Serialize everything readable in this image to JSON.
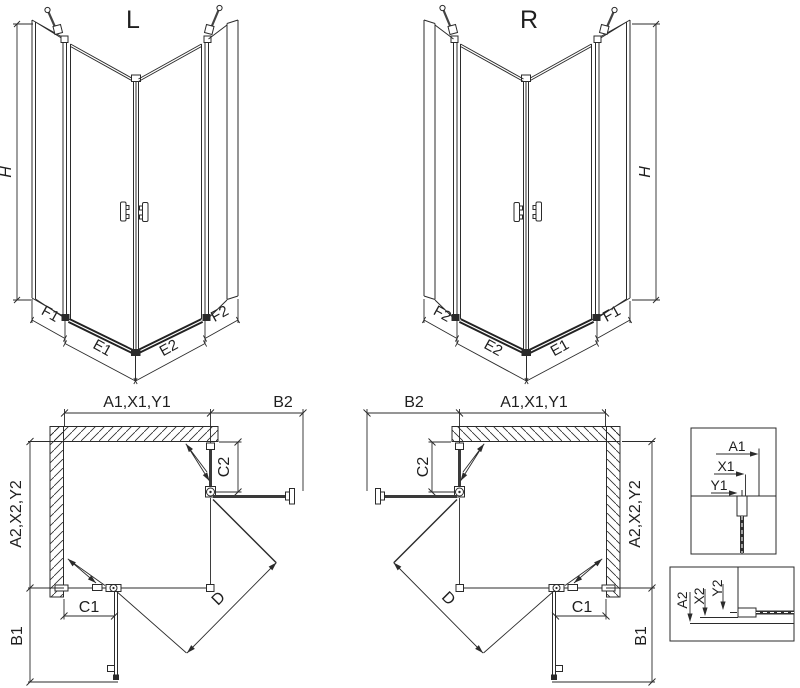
{
  "diagram_l3d": {
    "variant_label": "L",
    "height_dim": "H",
    "bottom_dims": {
      "f1": "F1",
      "e1": "E1",
      "e2": "E2",
      "f2": "F2"
    }
  },
  "diagram_r3d": {
    "variant_label": "R",
    "height_dim": "H",
    "bottom_dims": {
      "f1": "F1",
      "e1": "E1",
      "e2": "E2",
      "f2": "F2"
    }
  },
  "plan_left": {
    "top_dim": "A1,X1,Y1",
    "return_dim": "B2",
    "fixed_part_dim": "C2",
    "side_dim": "A2,X2,Y2",
    "door_dim": "C1",
    "diagonal_dim": "D",
    "bottom_dim": "B1"
  },
  "plan_right": {
    "top_dim": "A1,X1,Y1",
    "return_dim": "B2",
    "fixed_part_dim": "C2",
    "side_dim": "A2,X2,Y2",
    "door_dim": "C1",
    "diagonal_dim": "D",
    "bottom_dim": "B1"
  },
  "detail_top": {
    "dims": {
      "a1": "A1",
      "x1": "X1",
      "y1": "Y1"
    }
  },
  "detail_bottom": {
    "dims": {
      "a2": "A2",
      "x2": "X2",
      "y2": "Y2"
    }
  },
  "colors": {
    "line": "#2b2b2b",
    "accent_dark": "#222222",
    "background": "#ffffff"
  }
}
